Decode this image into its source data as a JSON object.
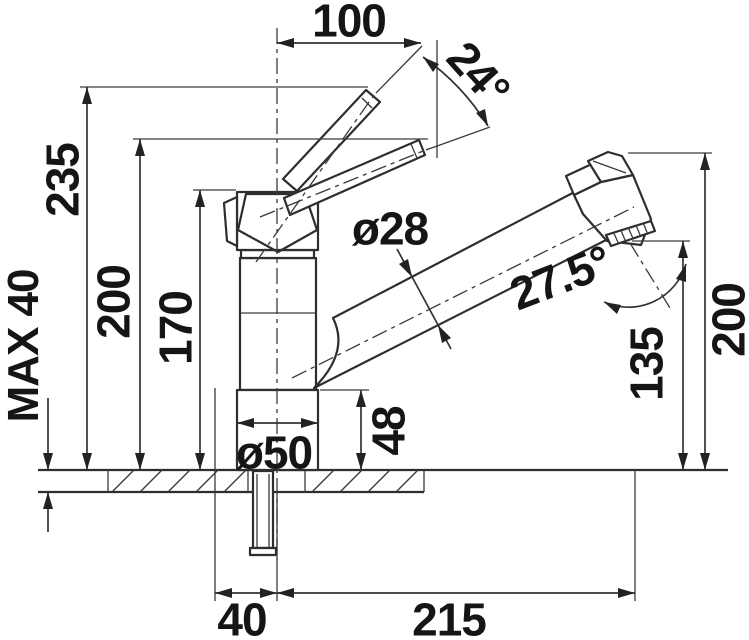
{
  "dims": {
    "top_width": "100",
    "handle_angle": "24°",
    "height_total": "235",
    "height_handle_down": "200",
    "height_body": "170",
    "max_counter_thickness": "MAX 40",
    "tube_diameter": "ø28",
    "head_angle": "27.5°",
    "base_diameter": "ø50",
    "base_height": "48",
    "outlet_height": "135",
    "head_top_height": "200",
    "hole_front_offset": "40",
    "reach": "215"
  }
}
